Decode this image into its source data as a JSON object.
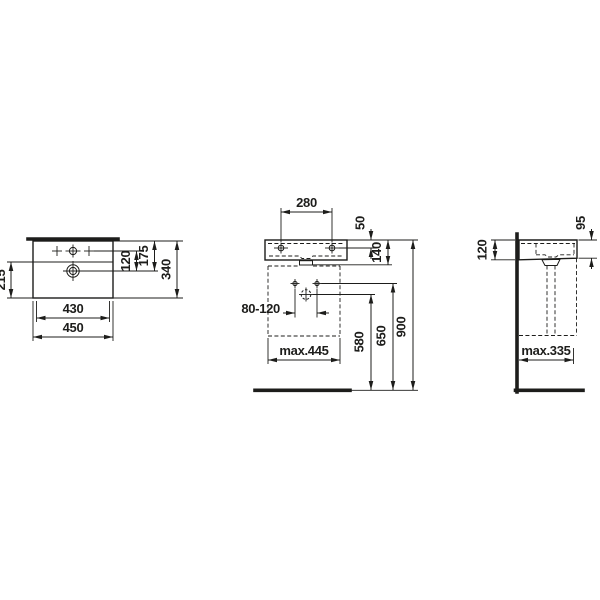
{
  "drawing": {
    "kind": "technical-dimension-drawing",
    "colors": {
      "line": "#1d1d1b",
      "background": "#ffffff"
    },
    "views": {
      "plan": {
        "label": "top view",
        "dims": {
          "bowl_front_depth": "215",
          "tap_to_drain": "120",
          "back_to_drain": "175",
          "overall_depth": "340",
          "inner_width": "430",
          "overall_width": "450"
        }
      },
      "front": {
        "label": "front view",
        "dims": {
          "fixing_hole_spacing": "280",
          "rim_to_fixing_holes": "50",
          "basin_height": "140",
          "supply_spacing": "80-120",
          "max_cabinet_width": "max.445",
          "drain_outlet_height": "580",
          "supply_height": "650",
          "rim_height": "900"
        }
      },
      "side": {
        "label": "side view",
        "dims": {
          "height_at_wall": "120",
          "height_at_front": "95",
          "max_cabinet_depth": "max.335"
        }
      }
    }
  }
}
